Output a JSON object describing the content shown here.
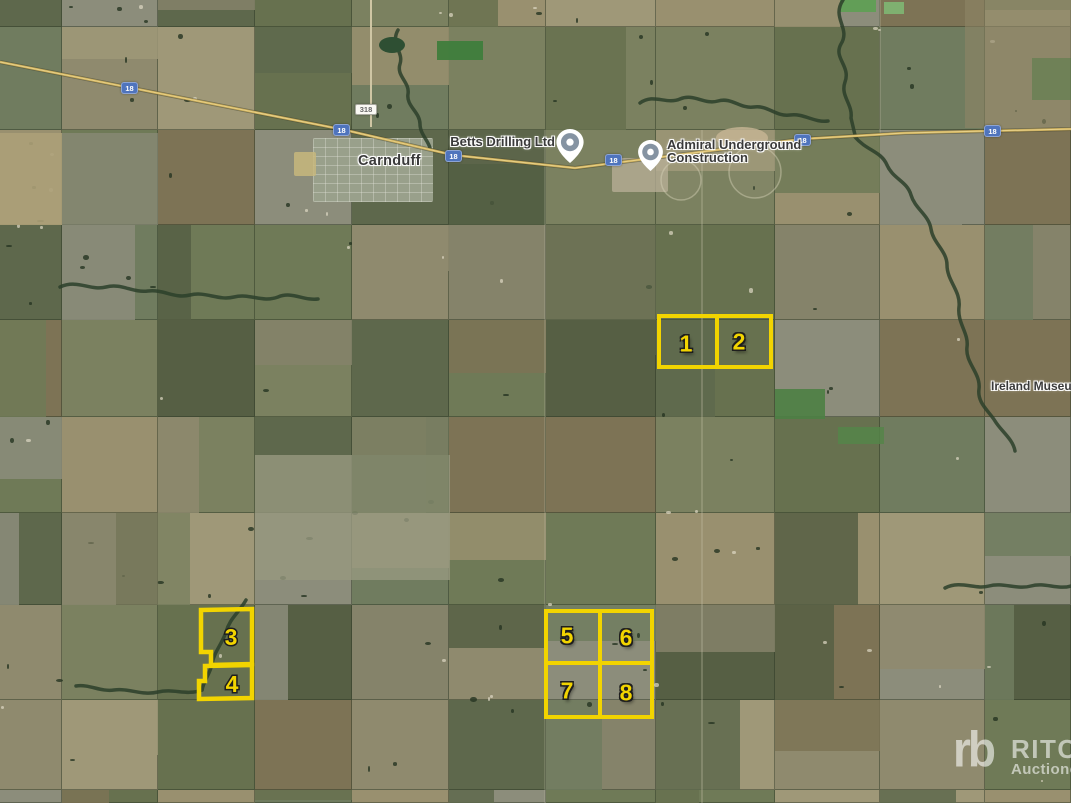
{
  "map": {
    "town_label": "Carnduff",
    "poi": {
      "betts": "Betts Drilling Ltd",
      "admiral_line1": "Admiral Underground",
      "admiral_line2": "Construction",
      "ireland": "Ireland Museum"
    },
    "shields": {
      "highway": "18",
      "secondary": "318"
    }
  },
  "parcels": {
    "labels": [
      "1",
      "2",
      "3",
      "4",
      "5",
      "6",
      "7",
      "8"
    ],
    "outline_color": "#f2d400"
  },
  "watermark": {
    "logo": "rb",
    "brand": "RITCHIE",
    "tagline": "Auctioneers"
  },
  "colors": {
    "shield_blue": "#4f74bd",
    "parcel_yellow": "#f2d400",
    "label_text": "#3a3a3a"
  }
}
